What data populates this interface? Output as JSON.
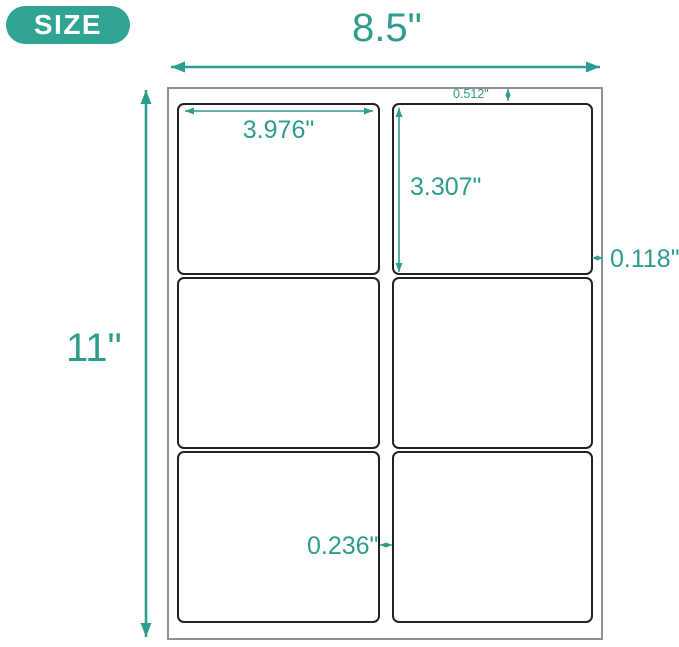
{
  "badge": {
    "label": "SIZE"
  },
  "sheet": {
    "width_label": "8.5\"",
    "height_label": "11\"",
    "rows": 3,
    "columns": 2
  },
  "labels": {
    "width_label": "3.976\"",
    "height_label": "3.307\"",
    "top_margin_label": "0.512\"",
    "side_margin_label": "0.118\"",
    "column_gap_label": "0.236\""
  },
  "colors": {
    "accent": "#2E9C8C",
    "badge_bg": "#2FA493",
    "sheet_border": "#8F8F8F",
    "label_border": "#222222"
  }
}
